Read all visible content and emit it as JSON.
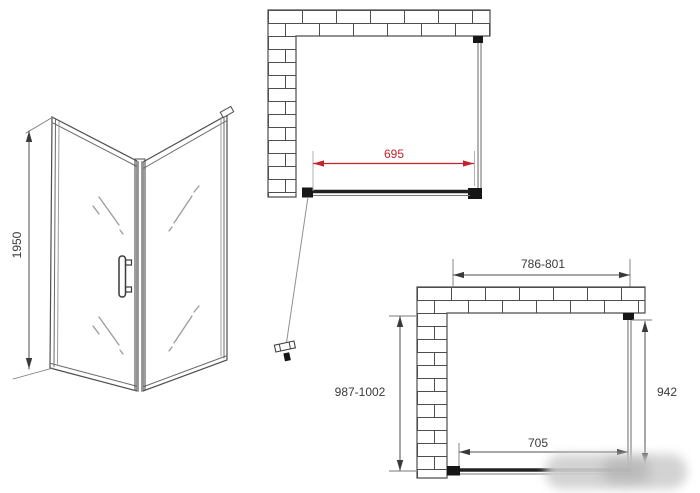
{
  "drawing": {
    "perspective": {
      "height": "1950"
    },
    "top_plan": {
      "glass_width": "695"
    },
    "bottom_plan": {
      "outer_width": "786-801",
      "outer_depth": "987-1002",
      "side_panel_depth": "942",
      "door_width": "705"
    }
  },
  "colors": {
    "line": "#4e4e4e",
    "frame_dark": "#161616",
    "accent_red": "#c4232b",
    "dim_text": "#3a3a3a",
    "glass_mark": "#9b9b9b"
  }
}
